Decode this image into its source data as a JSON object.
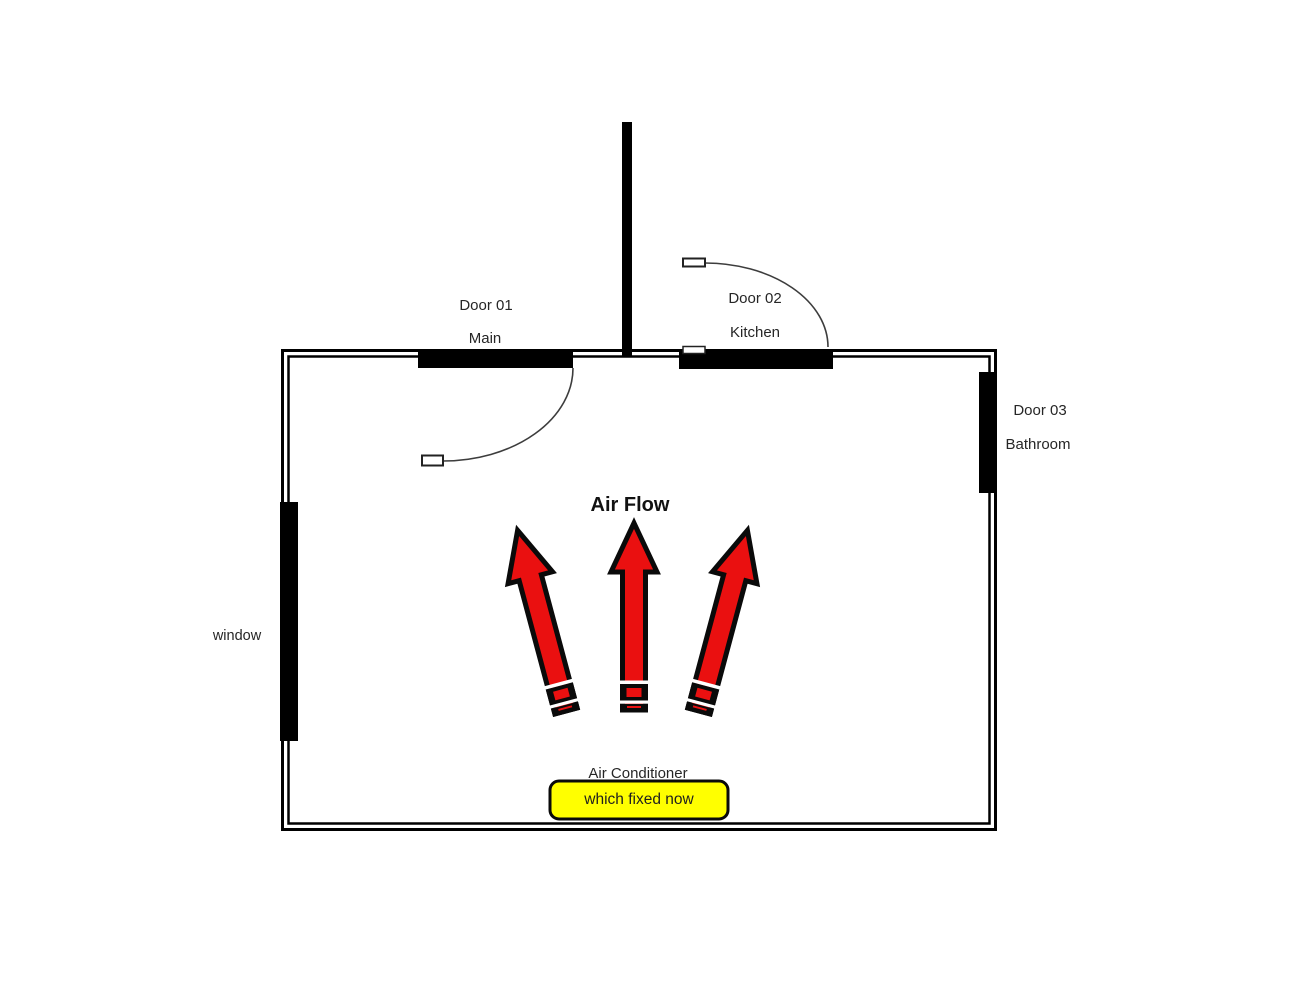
{
  "diagram": {
    "type": "floor-plan",
    "labels": {
      "door01": {
        "name": "Door 01",
        "room": "Main"
      },
      "door02": {
        "name": "Door 02",
        "room": "Kitchen"
      },
      "door03": {
        "name": "Door 03",
        "room": "Bathroom"
      },
      "window": "window",
      "air_flow": "Air Flow",
      "air_conditioner": "Air Conditioner",
      "highlight_note": "which fixed now"
    },
    "airflow_arrows": [
      "up-left",
      "up",
      "up-right"
    ],
    "colors": {
      "wall": "#000000",
      "arrow_red": "#ea1010",
      "arrow_outline": "#0a0a0a",
      "highlight_yellow": "#ffff00",
      "swing_arc": "#3d3d3d"
    }
  }
}
